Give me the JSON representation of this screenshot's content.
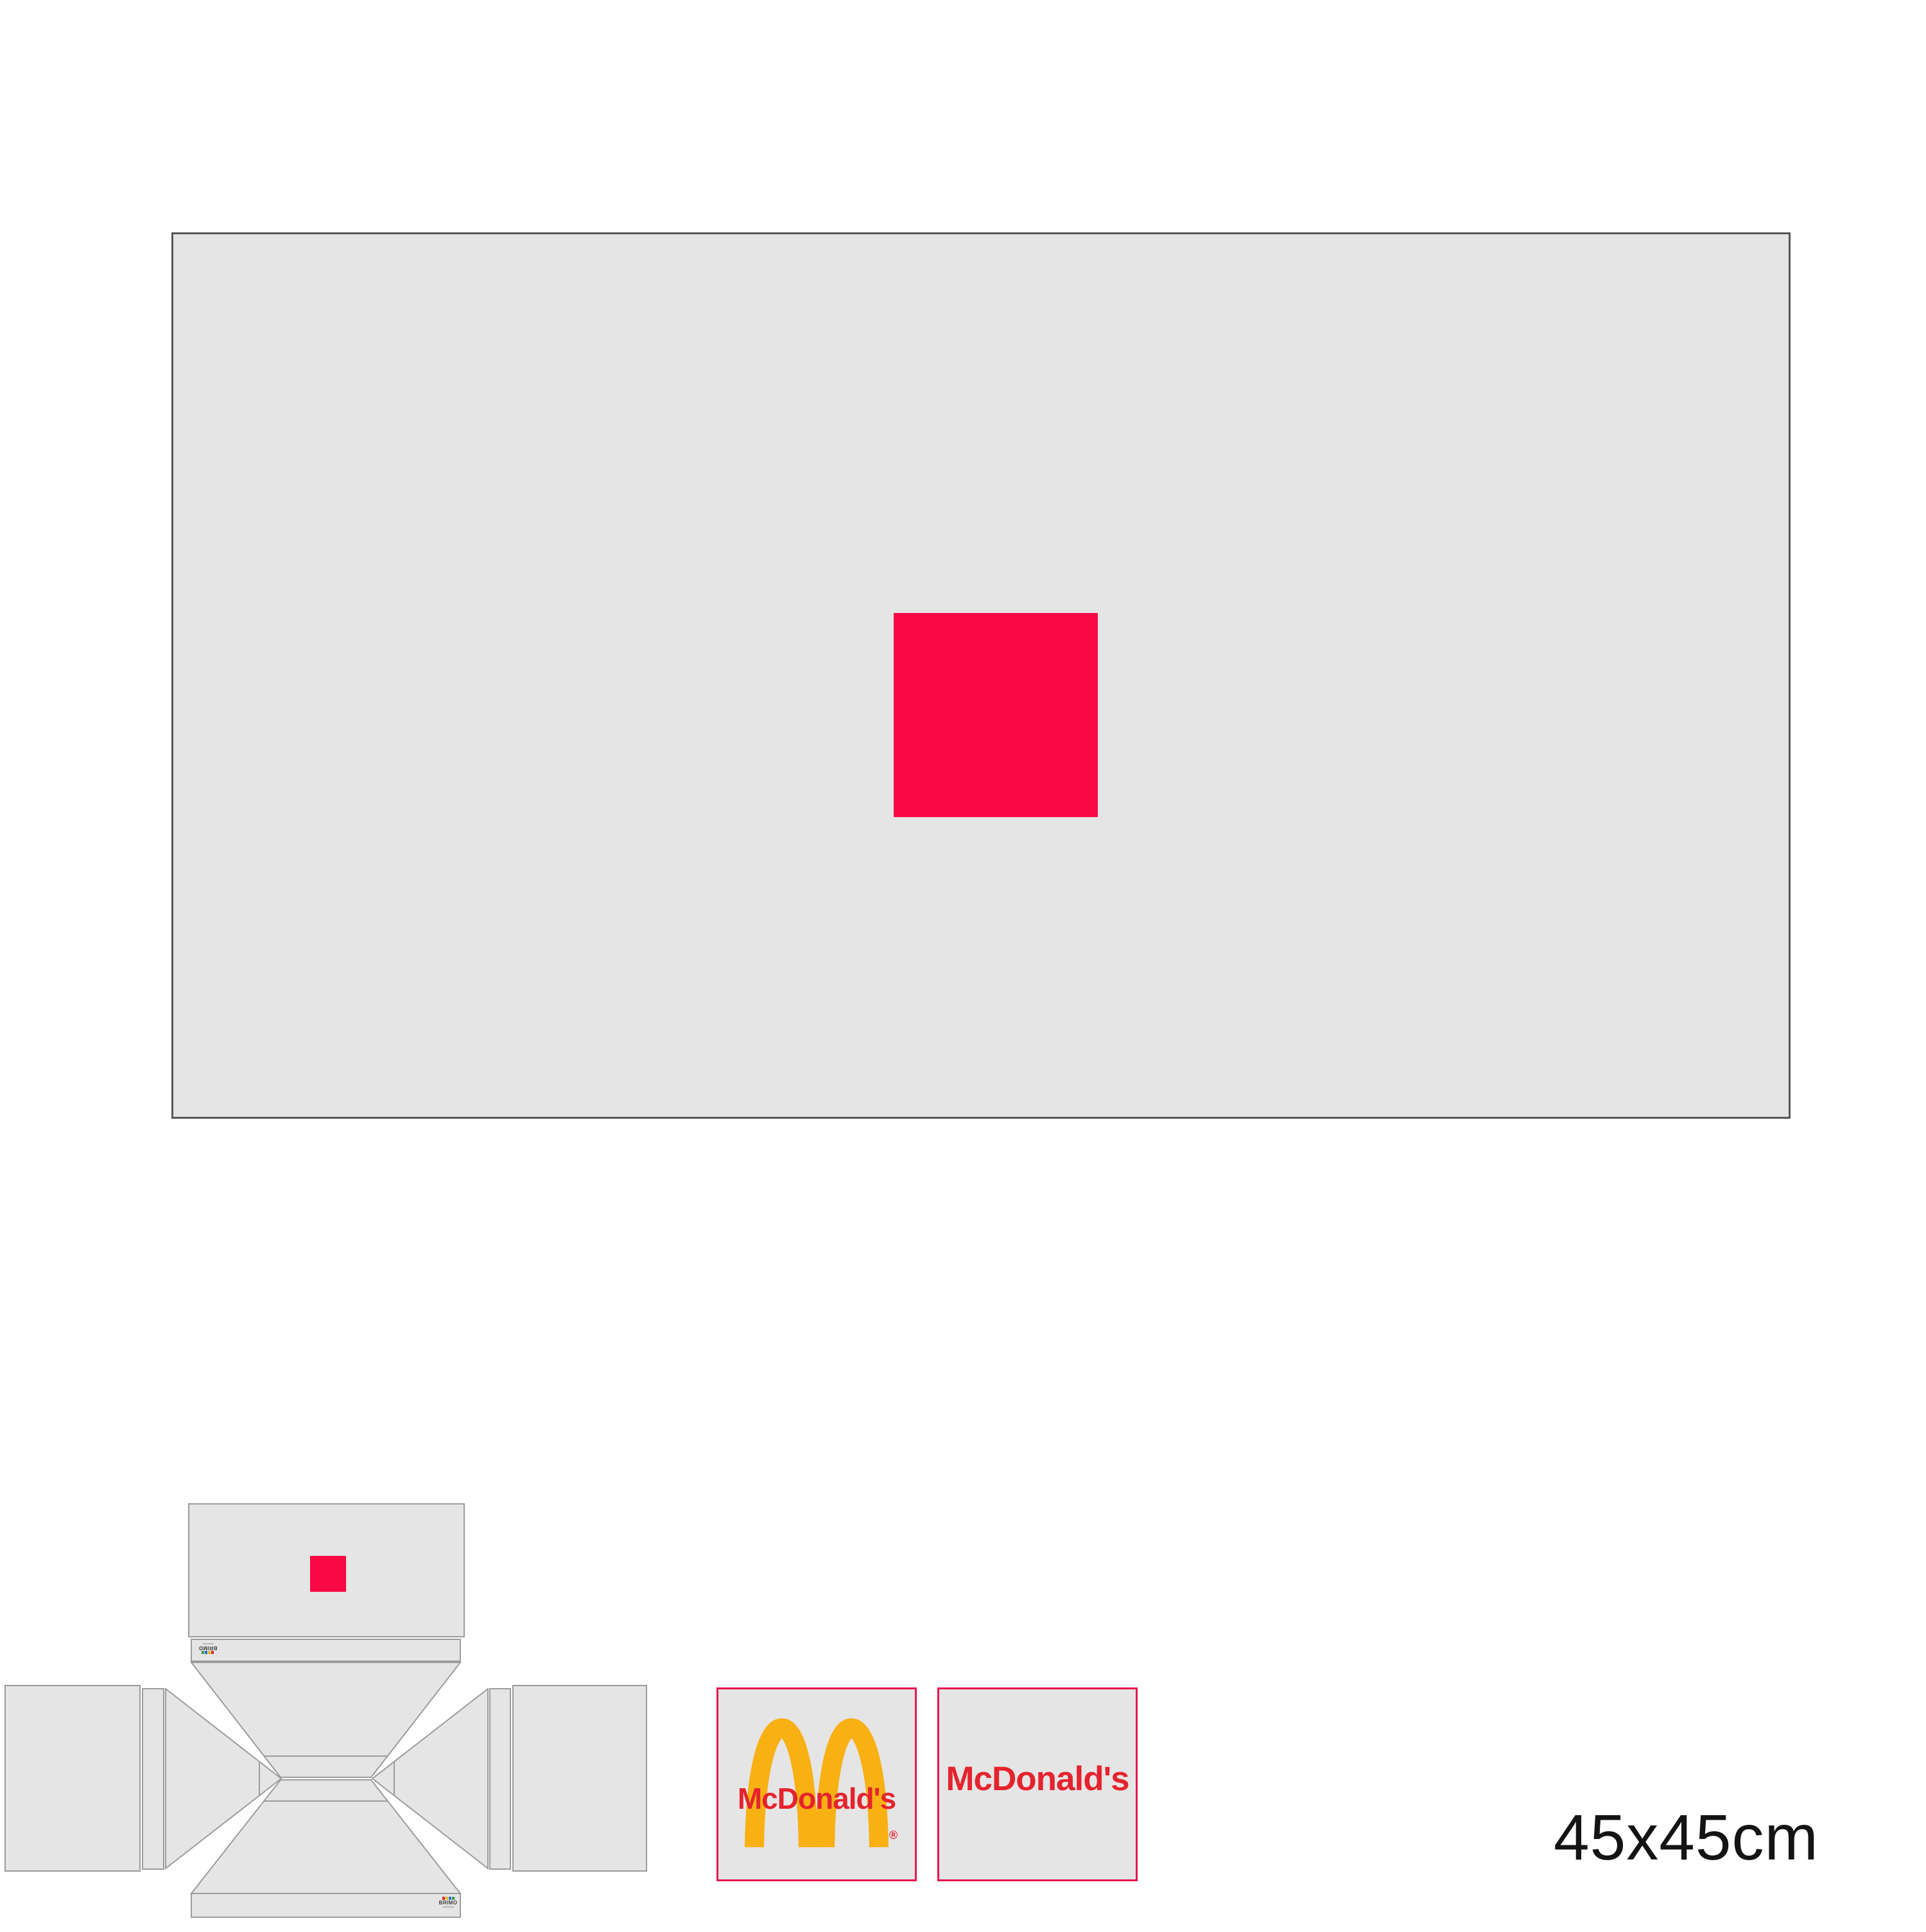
{
  "artwork": {
    "size_label": "45x45cm"
  },
  "brand": {
    "wordmark": "McDonald's",
    "registered_mark": "®",
    "supplier_logo_text": "BRIMO"
  },
  "colors": {
    "panel_gray": "#e5e5e5",
    "outline_gray": "#9c9c9c",
    "frame_gray": "#575757",
    "accent_red": "#fa0945",
    "logo_border_pink": "#e6174e",
    "mcdonalds_red": "#e5232e",
    "arches_gold": "#f8b013",
    "text_black": "#141414"
  }
}
